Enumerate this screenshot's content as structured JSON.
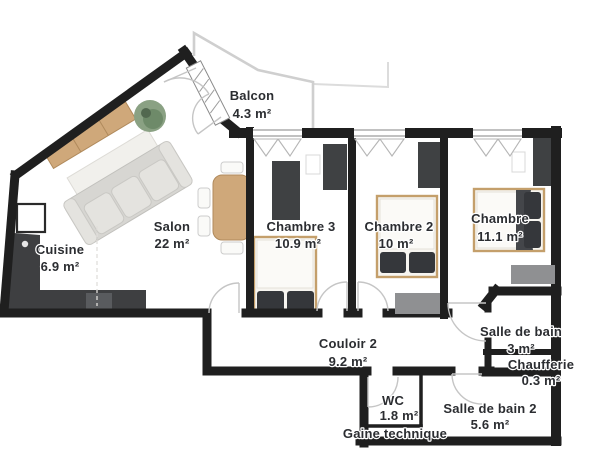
{
  "meta": {
    "type": "floor-plan",
    "language": "fr",
    "title": "Plan d'appartement"
  },
  "rooms": [
    {
      "id": "balcon",
      "name": "Balcon",
      "area": "4.3 m²"
    },
    {
      "id": "salon",
      "name": "Salon",
      "area": "22 m²"
    },
    {
      "id": "cuisine",
      "name": "Cuisine",
      "area": "6.9 m²"
    },
    {
      "id": "chambre-3",
      "name": "Chambre 3",
      "area": "10.9 m²"
    },
    {
      "id": "chambre-2",
      "name": "Chambre 2",
      "area": "10 m²"
    },
    {
      "id": "chambre",
      "name": "Chambre",
      "area": "11.1 m²"
    },
    {
      "id": "salle-de-bain",
      "name": "Salle de bain",
      "area": "3 m²"
    },
    {
      "id": "chaufferie",
      "name": "Chaufferie",
      "area": "0.3 m²"
    },
    {
      "id": "couloir-2",
      "name": "Couloir 2",
      "area": "9.2 m²"
    },
    {
      "id": "wc",
      "name": "WC",
      "area": "1.8 m²"
    },
    {
      "id": "salle-de-bain-2",
      "name": "Salle de bain 2",
      "area": "5.6 m²"
    },
    {
      "id": "gaine-technique",
      "name": "Gaine technique",
      "area": ""
    }
  ],
  "palette": {
    "wall": "#1f1f1f",
    "floor": "#ffffff",
    "wood": "#cfa87a",
    "sofa": "#e4e3df",
    "dark_furniture": "#3f4143",
    "gray_furniture": "#8f9092",
    "kitchen_counter": "#3e3f41",
    "pillow": "#35373b",
    "plant": "#7d9478",
    "door_symbol": "#c5c5c5",
    "label_text": "#2b2d31"
  },
  "icons": [
    "sofa",
    "rug",
    "sideboard",
    "plant",
    "dining-table",
    "chairs",
    "kitchen-counter",
    "sink",
    "hob",
    "tall-cabinet",
    "double-bed",
    "wardrobe",
    "dresser",
    "door-swing",
    "window",
    "balcony-railing"
  ]
}
